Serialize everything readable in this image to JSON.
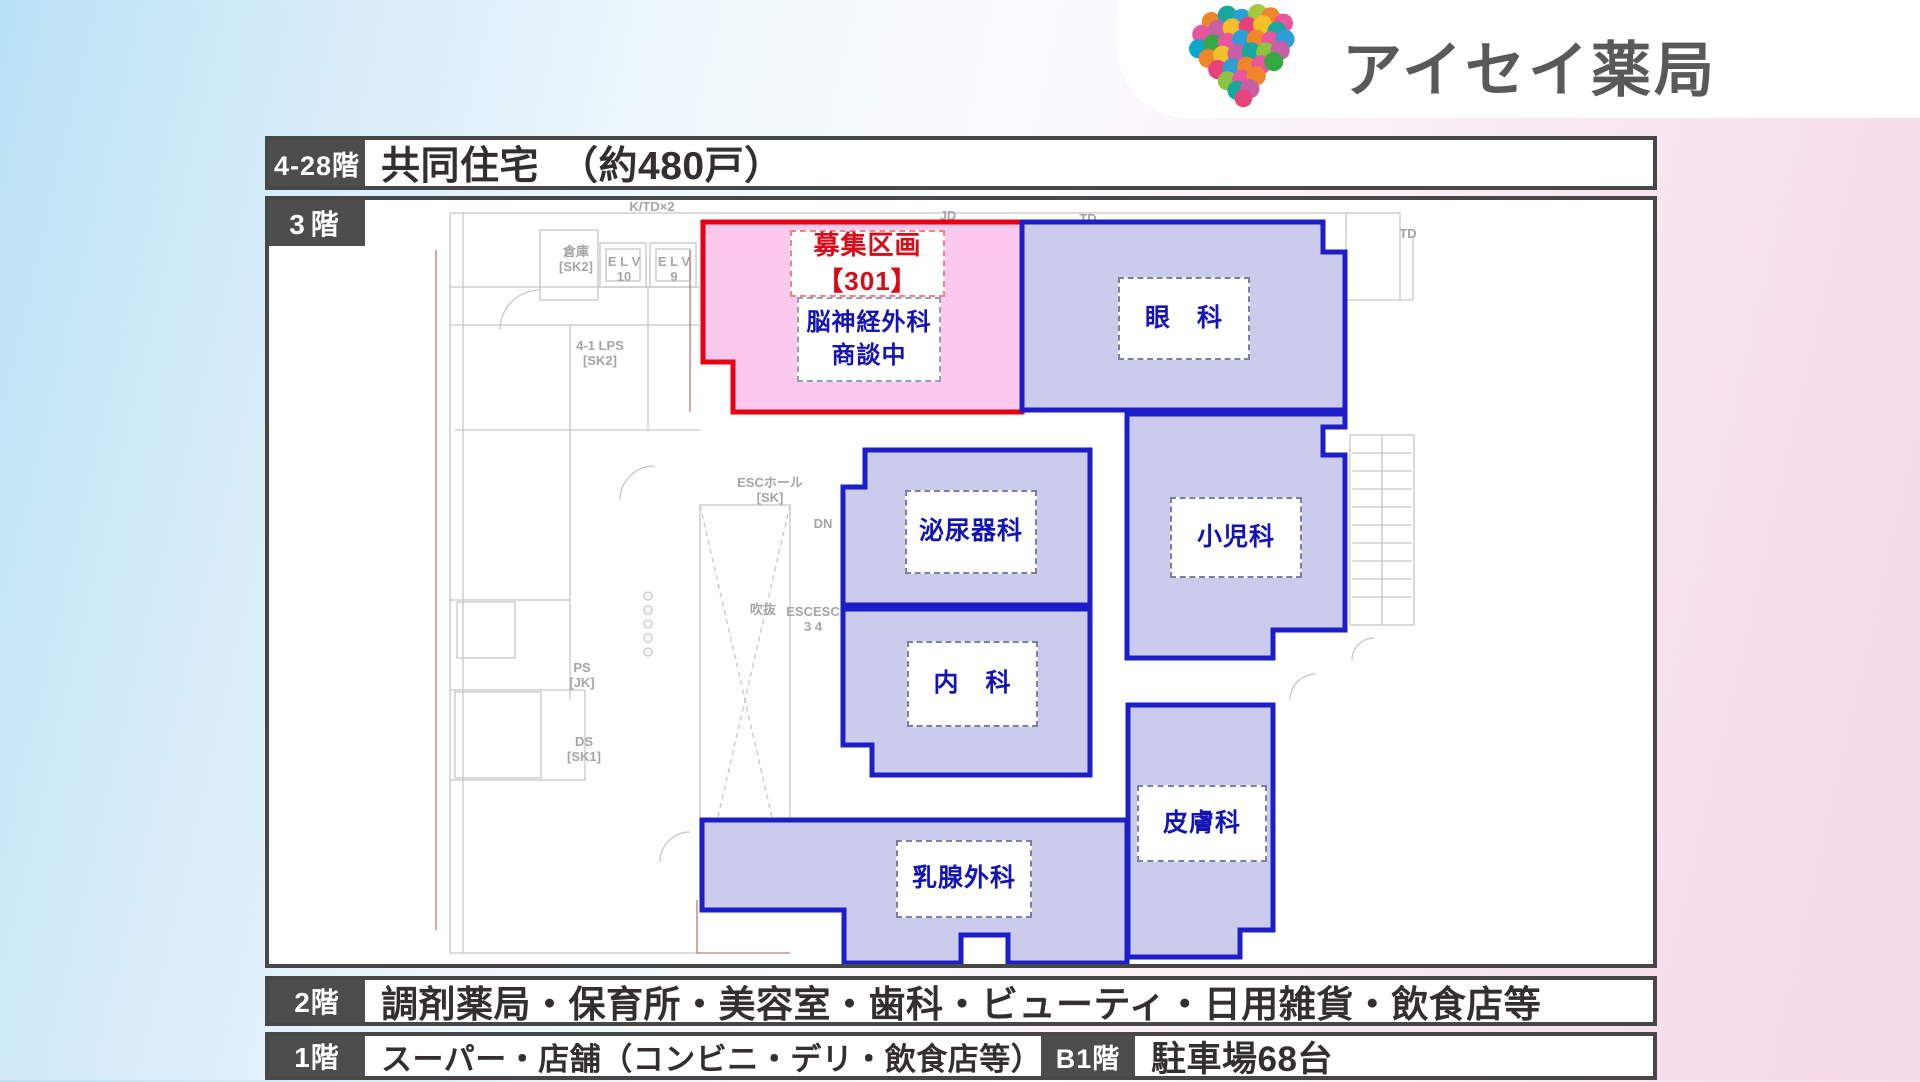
{
  "logo": {
    "text": "アイセイ薬局",
    "palette": [
      "#f0862c",
      "#18a79e",
      "#2c9fd8",
      "#e8579d",
      "#c95fa4",
      "#a3c93c",
      "#f3c02c",
      "#35a843",
      "#0aa7c9",
      "#e8417c"
    ]
  },
  "rows": {
    "residential": {
      "label": "4-28階",
      "content": "共同住宅　（約480戸）"
    },
    "floor2": {
      "label": "2階",
      "content": "調剤薬局・保育所・美容室・歯科・ビューティ・日用雑貨・飲食店等"
    },
    "floor1": {
      "label": "1階",
      "content": "スーパー・店舗（コンビニ・デリ・飲食店等）"
    },
    "basement": {
      "label": "B1階",
      "content": "駐車場68台"
    }
  },
  "plan": {
    "floor_label": "3階",
    "vacancy": {
      "line1": "募集区画",
      "line2": "【301】",
      "tenant": "脳神経外科",
      "status": "商談中"
    },
    "zones": {
      "ophthalmology": "眼　科",
      "urology": "泌尿器科",
      "pediatrics": "小児科",
      "internal_medicine": "内　科",
      "dermatology": "皮膚科",
      "breast_surgery": "乳腺外科"
    },
    "bg_labels": [
      "K/TD×2",
      "JD",
      "TD",
      "TD",
      "倉庫",
      "[SK2]",
      "E L V",
      "10",
      "E L V",
      "9",
      "4-1 LPS",
      "[SK2]",
      "ESCホール",
      "[SK]",
      "DN",
      "吹抜",
      "ESCESC",
      "3   4",
      "PS",
      "[JK]",
      "DS",
      "[SK1]"
    ]
  },
  "colors": {
    "zone_fill": "#cbcbec",
    "zone_border": "#1e1ec8",
    "vacancy_fill": "#fbc8ee",
    "vacancy_border": "#e60012",
    "zone_label_text": "#1414b4",
    "vacancy_label_text": "#d80c18",
    "frame": "#474747",
    "band_label_bg": "#4d4d4d",
    "background_blue": "#b9e2f6",
    "background_pink": "#f4d9e7"
  }
}
